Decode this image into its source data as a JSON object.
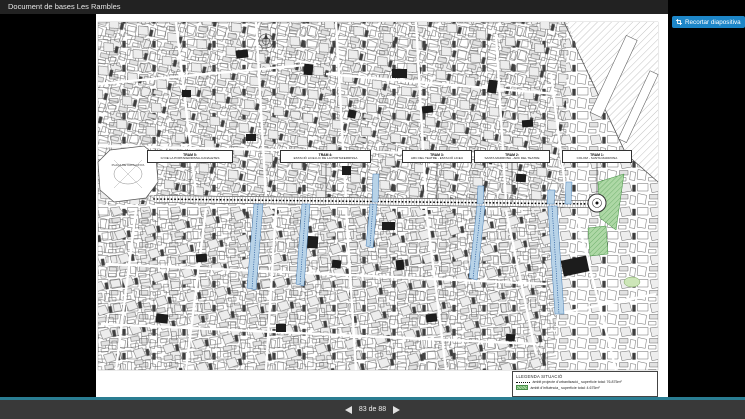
{
  "chrome": {
    "title": "Document de bases Les Rambles",
    "crop_button": "Recortar diapositiva",
    "pager": {
      "display": "83 de 88"
    },
    "colors": {
      "accent_teal": "#2a7d92",
      "button_blue": "#1d86c8",
      "highlight_blue": "#b8d3e8",
      "highlight_green": "#aed8a6"
    }
  },
  "slide": {
    "placa_label": "PLAÇA DE CATALUNYA",
    "tram_boxes": [
      {
        "line1": "TRAM 5:",
        "line2": "C/ DE LA PORTAFERRISSA-CANALETES"
      },
      {
        "line1": "TRAM 4:",
        "line2": "ESTACIÓ LICEU-C/ DE LA PORTAFERRISSA"
      },
      {
        "line1": "TRAM 3:",
        "line2": "ARC DEL TEATRE - ESTACIÓ LICEU"
      },
      {
        "line1": "TRAM 2:",
        "line2": "SANTA MADRONA - ARC DEL TEATRE"
      },
      {
        "line1": "TRAM 1:",
        "line2": "COLOM - SANTA MADRONA"
      }
    ],
    "legend": {
      "title": "LLEGENDA SITUACIÓ",
      "items": [
        {
          "symbol": "dotted-line",
          "label": "àmbit projecte d'urbanització_ superfície total: 76.875m²"
        },
        {
          "symbol": "green-hatch",
          "label": "àmbit d'influència_ superfície total: 4.675m²"
        }
      ]
    }
  }
}
